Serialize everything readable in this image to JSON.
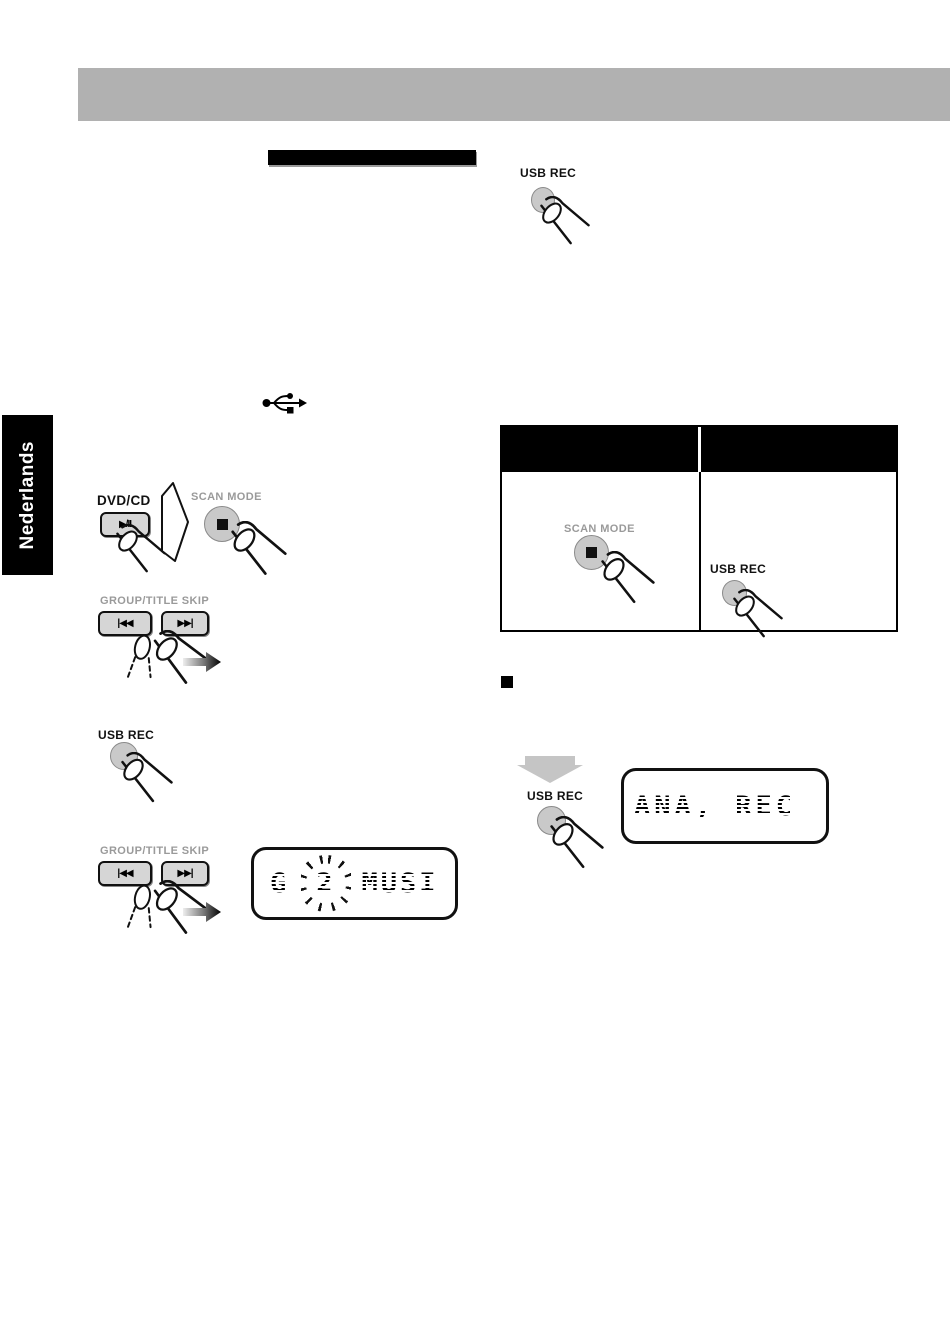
{
  "document": {
    "language_tab": "Nederlands"
  },
  "labels": {
    "usb_rec": "USB REC",
    "dvd_cd": "DVD/CD",
    "scan_mode": "SCAN MODE",
    "group_title_skip": "GROUP/TITLE SKIP"
  },
  "button_glyphs": {
    "play_pause": "▶/II",
    "skip_back": "|◀◀",
    "skip_forward": "▶▶|"
  },
  "displays": {
    "group": {
      "prefix": "G",
      "blinking": "2",
      "suffix": "MUSI"
    },
    "rec": {
      "text": "ANA, REC"
    }
  },
  "icons": {
    "usb": "usb-trident-icon",
    "finger": "pressing-finger-icon",
    "proceed_arrow": "proceed-arrow-icon",
    "fade_arrow": "press-repeatedly-arrow-icon",
    "down_arrow": "then-down-arrow-icon"
  },
  "colors": {
    "header_bar": "#b1b1b1",
    "pill_button_fill": "#d6d6d6",
    "round_button_fill": "#c9c9c9",
    "down_arrow_fill": "#c5c5c5",
    "ink": "#111111",
    "label_gray": "#9a9a9a"
  }
}
